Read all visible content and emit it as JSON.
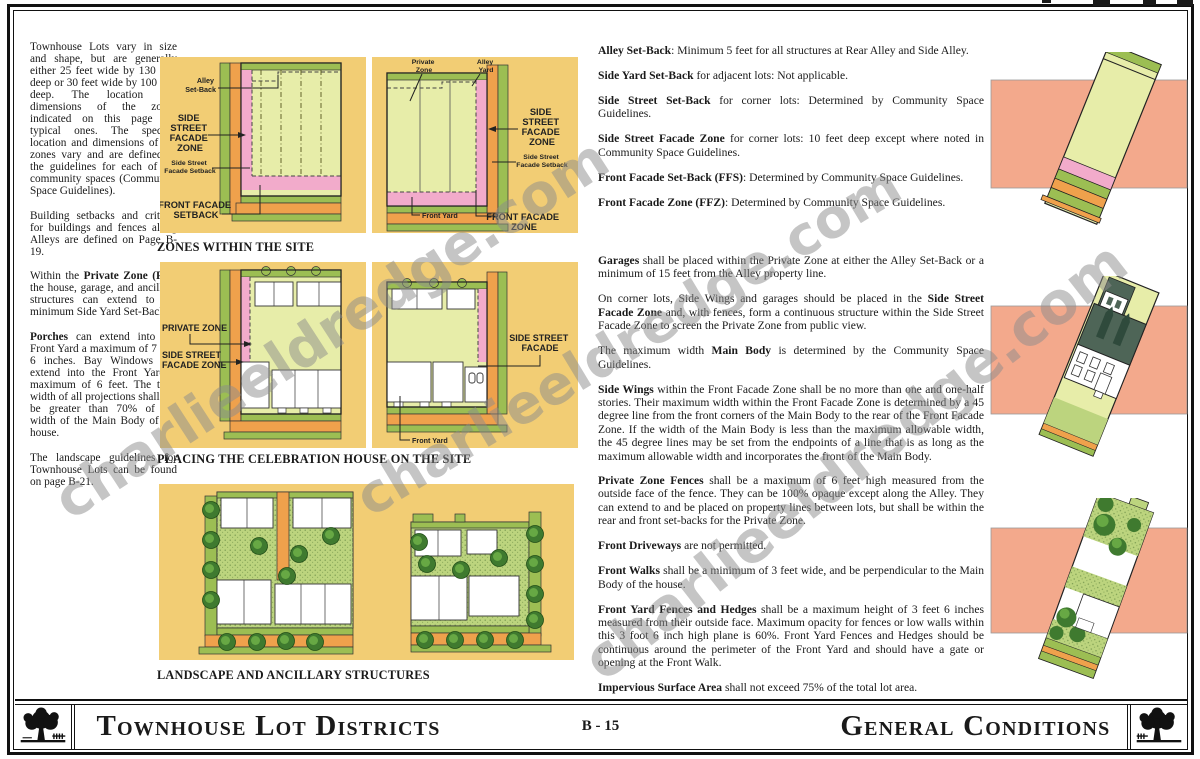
{
  "colors": {
    "panel_yellow": "#F2CD74",
    "strip_green": "#9CBE53",
    "street_orange": "#EFA14C",
    "zone_pink": "#F2ABCB",
    "lot_green": "#E7EDA9",
    "lawn_green": "#BCD47E",
    "tree_dark": "#3F7A2F",
    "tree_mid": "#67A844",
    "salmon": "#F3A98C",
    "roof_dark": "#4E6557",
    "ink": "#1A1A1A",
    "watermark_gray": "#8C8C8C"
  },
  "watermark": {
    "text": "charlieeldredge.com"
  },
  "left_column": {
    "paragraphs": [
      [
        {
          "t": "Townhouse Lots vary in size and shape, but are generally either 25 feet wide by 130 feet deep or 30 feet wide by 100 feet deep. The location and dimensions of the zones indicated on this page are typical ones. The specific location and dimensions of the zones vary and are defined in the guidelines for each of the community spaces (Community Space Guidelines)."
        }
      ],
      [
        {
          "t": "Building setbacks and criteria for buildings and fences along Alleys are defined on Page B-19."
        }
      ],
      [
        {
          "t": "Within the "
        },
        {
          "b": 1,
          "t": "Private Zone (PZ)"
        },
        {
          "t": ", the house, garage, and ancillary structures can extend to the minimum Side Yard Set-Back."
        }
      ],
      [
        {
          "b": 1,
          "t": "Porches"
        },
        {
          "t": " can extend into the Front Yard a maximum of 7 feet 6 inches. Bay Windows can extend into the Front Yard a maximum of 6 feet. The total width of all projections shall not be greater than 70% of the width of the Main Body of the house."
        }
      ],
      [
        {
          "t": "The landscape guidelines for Townhouse Lots can be found on page B-21."
        }
      ]
    ]
  },
  "right_column": {
    "block1": [
      [
        {
          "b": 1,
          "t": "Alley Set-Back"
        },
        {
          "t": ": Minimum 5 feet for all structures at Rear Alley and Side Alley."
        }
      ],
      [
        {
          "b": 1,
          "t": "Side Yard Set-Back"
        },
        {
          "t": " for adjacent lots: Not applicable."
        }
      ],
      [
        {
          "b": 1,
          "t": "Side Street Set-Back"
        },
        {
          "t": " for corner lots: Determined by Community Space Guidelines."
        }
      ],
      [
        {
          "b": 1,
          "t": "Side Street Facade Zone"
        },
        {
          "t": " for corner lots: 10 feet deep except where noted in Community Space Guidelines."
        }
      ],
      [
        {
          "b": 1,
          "t": "Front Facade Set-Back (FFS)"
        },
        {
          "t": ": Determined by Community Space Guidelines."
        }
      ],
      [
        {
          "b": 1,
          "t": "Front Facade Zone (FFZ)"
        },
        {
          "t": ": Determined by Community Space Guidelines."
        }
      ]
    ],
    "block2": [
      [
        {
          "b": 1,
          "t": "Garages"
        },
        {
          "t": " shall be placed within the Private Zone at either the Alley Set-Back or a minimum of 15 feet from the Alley property line."
        }
      ],
      [
        {
          "t": "On corner lots, Side Wings and garages should be placed in the "
        },
        {
          "b": 1,
          "t": "Side Street Facade Zone"
        },
        {
          "t": " and, with fences, form a continuous structure within the Side Street Facade Zone to screen the Private Zone from public view."
        }
      ],
      [
        {
          "t": "The maximum width "
        },
        {
          "b": 1,
          "t": "Main Body"
        },
        {
          "t": " is determined by the Community Space Guidelines."
        }
      ],
      [
        {
          "b": 1,
          "t": "Side Wings"
        },
        {
          "t": " within the Front Facade Zone shall be no more than one and one-half stories. Their maximum width within the Front Facade Zone is determined by a 45 degree line from the front corners of the Main Body to the rear of the Front Facade Zone. If the width of the Main Body is less than the maximum allowable width, the 45 degree lines may be set from the endpoints of a line that is as long as the maximum allowable width and incorporates the front of the Main Body."
        }
      ]
    ],
    "block3": [
      [
        {
          "b": 1,
          "t": "Private Zone Fences"
        },
        {
          "t": " shall be a maximum of 6 feet high measured from the outside face of the fence. They can be 100% opaque except along the Alley. They can extend to and be placed on property lines between lots, but shall be within the rear and front set-backs for the Private Zone."
        }
      ],
      [
        {
          "b": 1,
          "t": "Front Driveways"
        },
        {
          "t": " are not permitted."
        }
      ],
      [
        {
          "b": 1,
          "t": "Front Walks"
        },
        {
          "t": " shall be a minimum of 3 feet wide, and be perpendicular to the Main Body of the house."
        }
      ],
      [
        {
          "b": 1,
          "t": "Front Yard Fences and Hedges"
        },
        {
          "t": " shall be a maximum height of 3 feet 6 inches measured from their outside face. Maximum opacity for fences or low walls within this 3 foot 6 inch high plane is 60%. Front Yard Fences and Hedges should be continuous around the perimeter of the Front Yard and should have a gate or opening at the Front Walk."
        }
      ],
      [
        {
          "b": 1,
          "t": "Impervious Surface Area"
        },
        {
          "t": " shall not exceed 75% of the total lot area."
        }
      ]
    ]
  },
  "diagram_labels": {
    "zones": {
      "caption": "ZONES WITHIN THE SITE",
      "alley_setback": [
        "Alley",
        "Set-Back"
      ],
      "side_street_facade_zone": [
        "SIDE",
        "STREET",
        "FACADE",
        "ZONE"
      ],
      "side_street_facade_setback": [
        "Side Street",
        "Facade Setback"
      ],
      "front_facade_setback": [
        "FRONT FACADE",
        "SETBACK"
      ],
      "private_zone": [
        "Private",
        "Zone"
      ],
      "alley_yard": [
        "Alley",
        "Yard"
      ],
      "front_yard": "Front Yard",
      "front_facade_zone": [
        "FRONT FACADE",
        "ZONE"
      ]
    },
    "placing": {
      "caption": "PLACING THE CELEBRATION HOUSE ON THE SITE",
      "private_zone": "PRIVATE ZONE",
      "side_street_facade_zone": [
        "SIDE STREET",
        "FACADE ZONE"
      ],
      "side_street_facade": [
        "SIDE STREET",
        "FACADE"
      ],
      "front_yard": "Front Yard"
    },
    "landscape": {
      "caption": "LANDSCAPE AND ANCILLARY STRUCTURES"
    }
  },
  "footer": {
    "left_title": "Townhouse Lot Districts",
    "page_number": "B - 15",
    "right_title": "General Conditions"
  }
}
